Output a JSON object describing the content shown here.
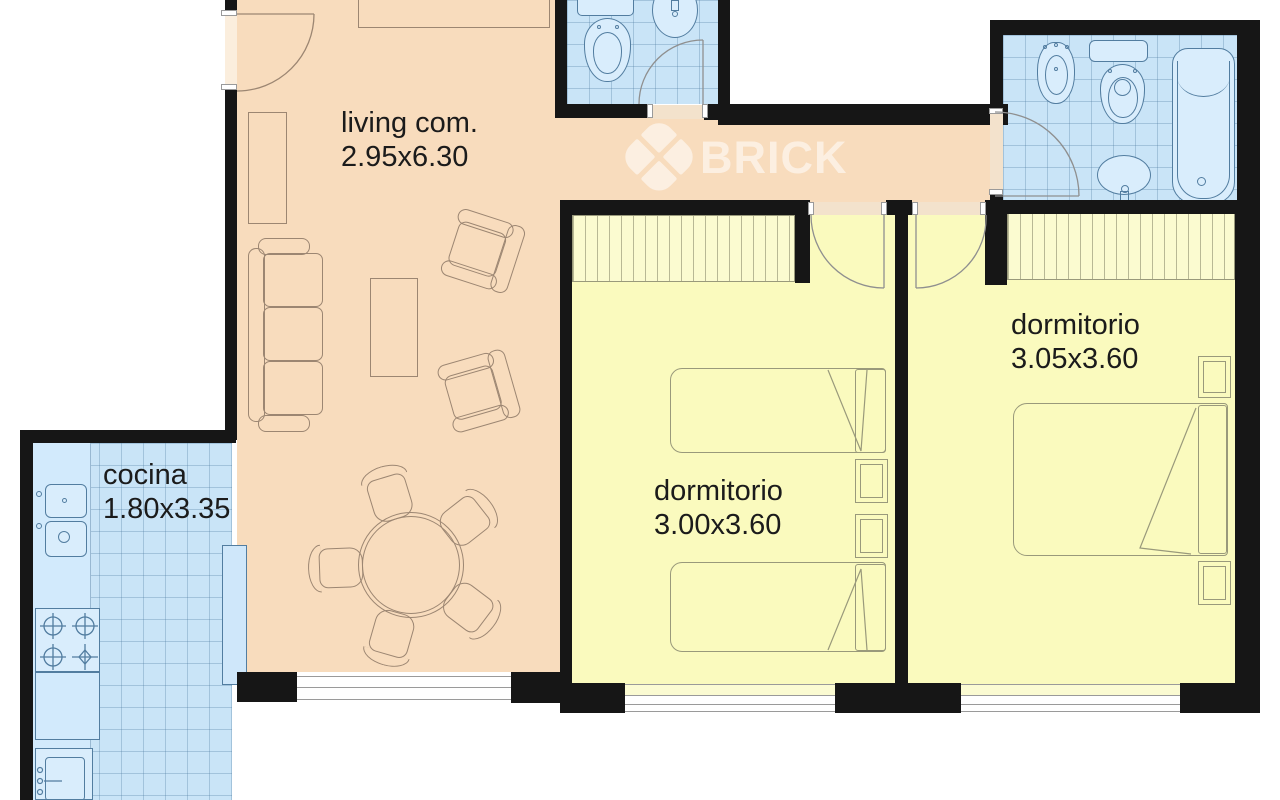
{
  "watermark": {
    "brand": "BRICK",
    "logo_icon": "brick-diamond-logo"
  },
  "rooms": {
    "living": {
      "name": "living com.",
      "dims": "2.95x6.30"
    },
    "cocina": {
      "name": "cocina",
      "dims": "1.80x3.35"
    },
    "dormitorio1": {
      "name": "dormitorio",
      "dims": "3.00x3.60"
    },
    "dormitorio2": {
      "name": "dormitorio",
      "dims": "3.05x3.60"
    }
  },
  "fixtures": {
    "living": [
      "sofa",
      "armchair",
      "armchair",
      "coffee-table",
      "round-dining-table",
      "dining-chair",
      "bookshelf",
      "sideboard"
    ],
    "cocina": [
      "double-sink",
      "stove-4-burners",
      "counter",
      "washing-machine"
    ],
    "bath1": [
      "toilet",
      "oval-sink",
      "door"
    ],
    "bath2": [
      "bidet",
      "toilet",
      "oval-sink",
      "bathtub",
      "door"
    ],
    "dorm1": [
      "closet",
      "single-bed",
      "single-bed",
      "nightstand",
      "nightstand",
      "door"
    ],
    "dorm2": [
      "closet",
      "double-bed",
      "nightstand",
      "nightstand",
      "door"
    ]
  },
  "colors": {
    "living_floor": "#f8dcbd",
    "bedroom_floor": "#fafabe",
    "wet_floor": "#c9e4f7",
    "wall": "#161616",
    "furniture_line_warm": "#9c8672",
    "furniture_line_cool": "#527da0",
    "furniture_line_bed": "#99997b",
    "label_text": "#1b1b1b"
  }
}
